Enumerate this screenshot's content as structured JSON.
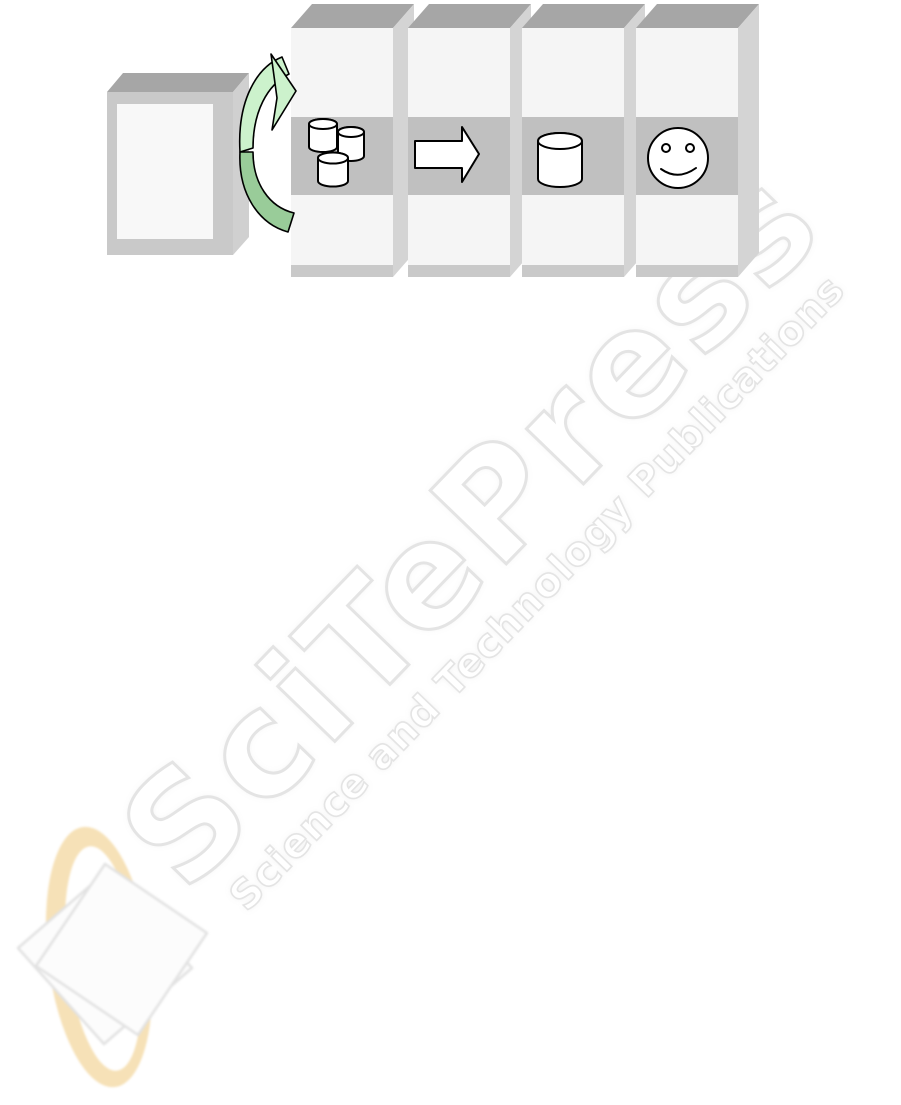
{
  "watermark": {
    "brand_text": "SciTePress",
    "tagline_text": "Science and Technology Publications"
  },
  "figure": {
    "source_box_icon": "document-source-box",
    "cycle_arrow_icon": "green-cycle-arrow",
    "panels": [
      {
        "icon": "database-cluster-icon"
      },
      {
        "icon": "transform-arrow-icon"
      },
      {
        "icon": "database-icon"
      },
      {
        "icon": "user-smiley-icon"
      }
    ]
  },
  "colors": {
    "page_bg": "#ffffff",
    "panel_top": "#a6a6a6",
    "panel_side": "#d4d4d4",
    "panel_face": "#f5f5f5",
    "panel_band": "#c0c0c0",
    "panel_lip": "#c9c9c9",
    "box_frame": "#c9c9c9",
    "box_inner": "#f8f8f8",
    "green_light": "#ccf2cc",
    "green_dark": "#99cc99",
    "outline": "#000000",
    "watermark_stroke": "#e4e4e4",
    "logo_orange": "#f5dcaa",
    "sheet_border": "#e2e2e2"
  }
}
